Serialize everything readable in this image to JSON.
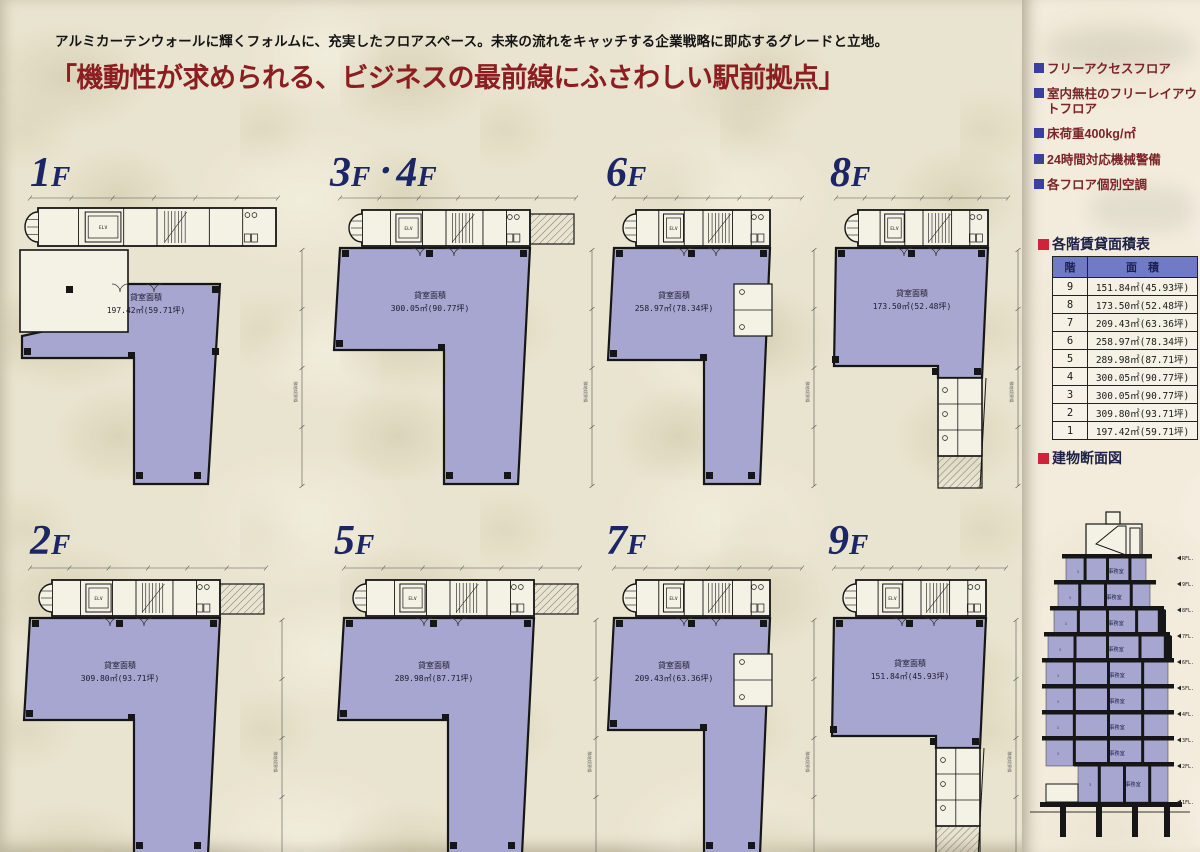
{
  "page": {
    "intro": "アルミカーテンウォールに輝くフォルムに、充実したフロアスペース。未来の流れをキャッチする企業戦略に即応するグレードと立地。",
    "headline": "「機動性が求められる、ビジネスの最前線にふさわしい駅前拠点」"
  },
  "features": {
    "items": [
      "フリーアクセスフロア",
      "室内無柱のフリーレイアウトフロア",
      "床荷重400kg/㎡",
      "24時間対応機械警備",
      "各フロア個別空調"
    ]
  },
  "area_table": {
    "title": "各階賃貸面積表",
    "columns": [
      "階",
      "面積"
    ],
    "rows": [
      {
        "floor": "9",
        "area": "151.84㎡(45.93坪)"
      },
      {
        "floor": "8",
        "area": "173.50㎡(52.48坪)"
      },
      {
        "floor": "7",
        "area": "209.43㎡(63.36坪)"
      },
      {
        "floor": "6",
        "area": "258.97㎡(78.34坪)"
      },
      {
        "floor": "5",
        "area": "289.98㎡(87.71坪)"
      },
      {
        "floor": "4",
        "area": "300.05㎡(90.77坪)"
      },
      {
        "floor": "3",
        "area": "300.05㎡(90.77坪)"
      },
      {
        "floor": "2",
        "area": "309.80㎡(93.71坪)"
      },
      {
        "floor": "1",
        "area": "197.42㎡(59.71坪)"
      }
    ]
  },
  "section_view": {
    "title": "建物断面図",
    "room_label": "事務室",
    "levels": [
      "RFL",
      "9FL",
      "8FL",
      "7FL",
      "6FL",
      "5FL",
      "4FL",
      "3FL",
      "2FL",
      "1FL"
    ]
  },
  "floor_plans": [
    {
      "name": "1F",
      "area_label": "貸室面積",
      "area": "197.42㎡(59.71坪)",
      "variant": "ground",
      "boundary": "隣地境界線"
    },
    {
      "name": "3F・4F",
      "area_label": "貸室面積",
      "area": "300.05㎡(90.77坪)",
      "variant": "wide",
      "boundary": "隣地境界線"
    },
    {
      "name": "6F",
      "area_label": "貸室面積",
      "area": "258.97㎡(78.34坪)",
      "variant": "narrow",
      "boundary": "隣地境界線"
    },
    {
      "name": "8F",
      "area_label": "貸室面積",
      "area": "173.50㎡(52.48坪)",
      "variant": "small",
      "boundary": "隣地境界線"
    },
    {
      "name": "2F",
      "area_label": "貸室面積",
      "area": "309.80㎡(93.71坪)",
      "variant": "wide",
      "boundary": "隣地境界線"
    },
    {
      "name": "5F",
      "area_label": "貸室面積",
      "area": "289.98㎡(87.71坪)",
      "variant": "wide",
      "boundary": "隣地境界線"
    },
    {
      "name": "7F",
      "area_label": "貸室面積",
      "area": "209.43㎡(63.36坪)",
      "variant": "narrow",
      "boundary": "隣地境界線"
    },
    {
      "name": "9F",
      "area_label": "貸室面積",
      "area": "151.84㎡(45.93坪)",
      "variant": "small",
      "boundary": "隣地境界線"
    }
  ],
  "plan_annotations": {
    "elevator": "ELV"
  },
  "colors": {
    "paper": "#e9e4cf",
    "right_paper": "#f3ecdd",
    "plan_purple": "#a7a6d0",
    "room_white": "#f4f1e5",
    "wall_black": "#161616",
    "navy": "#1c2666",
    "headline_red": "#8c1d20",
    "feature_text": "#7c2428",
    "bullet_blue": "#3a3fa0",
    "bullet_red": "#cf2438",
    "table_header": "#6f7cc5"
  }
}
